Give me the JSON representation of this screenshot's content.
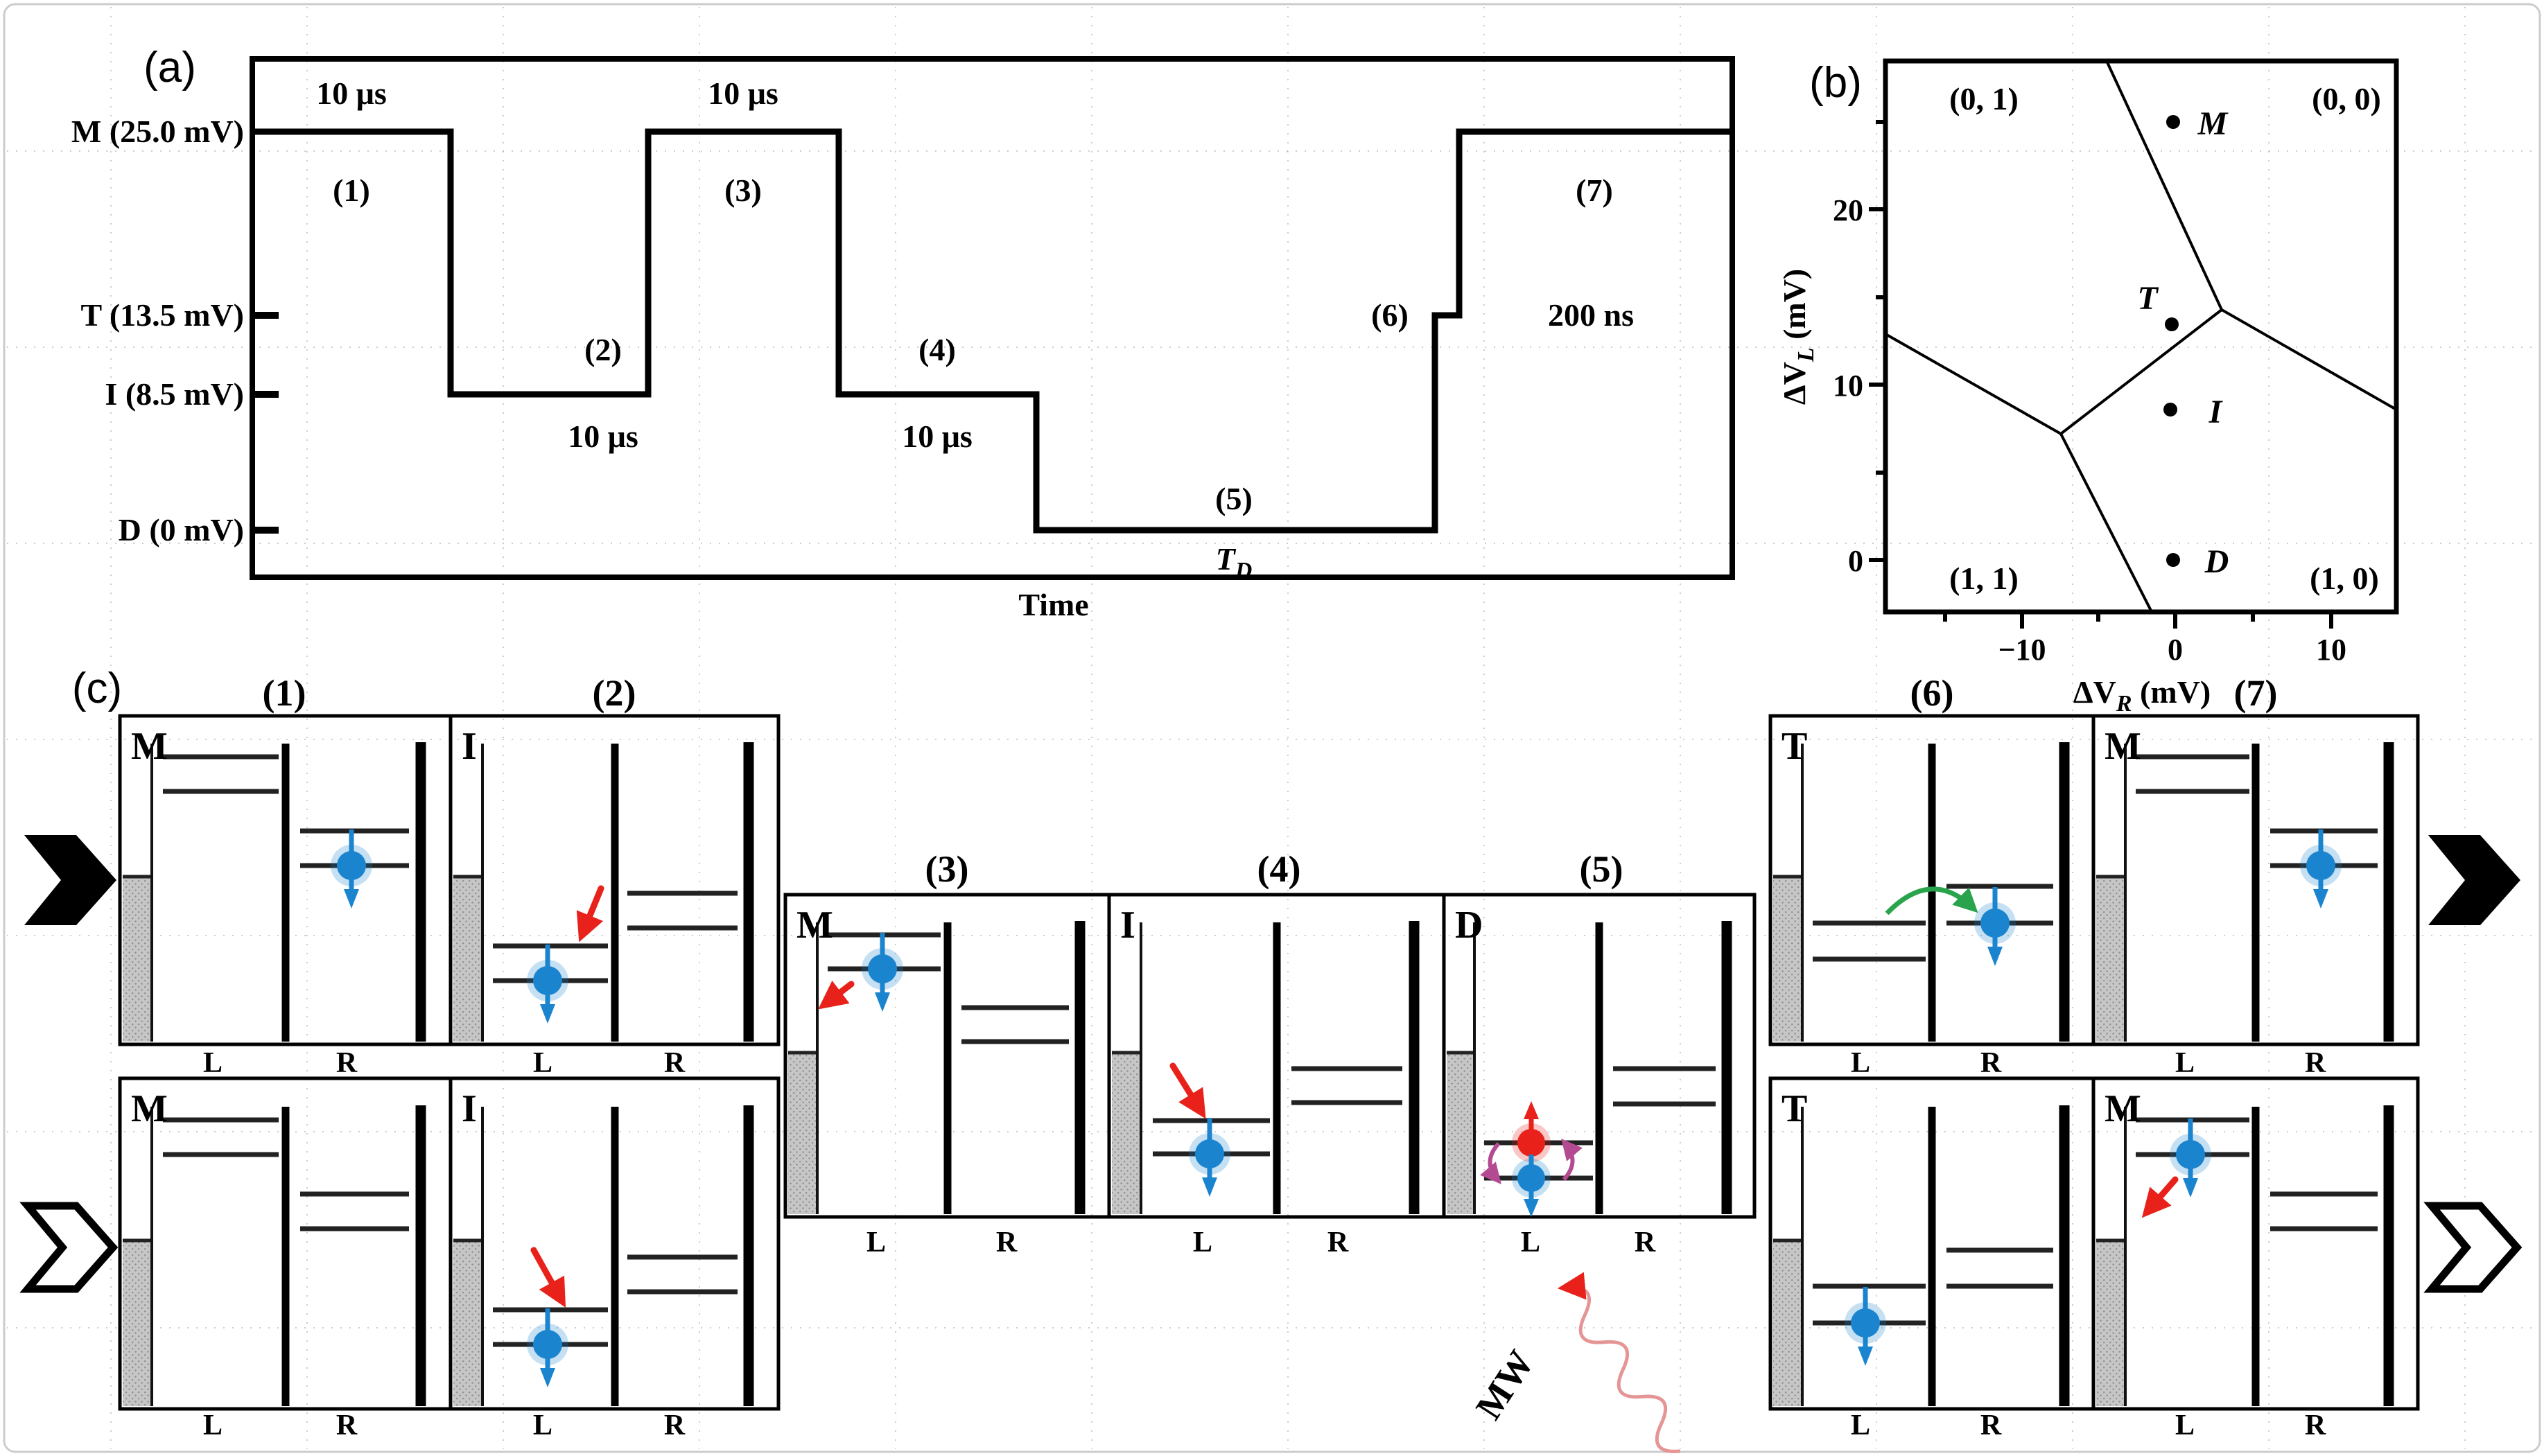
{
  "panel_a": {
    "tag": "(a)",
    "levels": [
      {
        "name": "M",
        "label": "M (25.0 mV)",
        "mV": 25
      },
      {
        "name": "T",
        "label": "T (13.5 mV)",
        "mV": 13.5
      },
      {
        "name": "I",
        "label": "I (8.5 mV)",
        "mV": 8.5
      },
      {
        "name": "D",
        "label": "D (0 mV)",
        "mV": 0
      }
    ],
    "x_axis_label": "Time",
    "stages": [
      {
        "id": "(1)",
        "level": "M",
        "duration": "10 μs"
      },
      {
        "id": "(2)",
        "level": "I",
        "duration": "10 μs"
      },
      {
        "id": "(3)",
        "level": "M",
        "duration": "10 μs"
      },
      {
        "id": "(4)",
        "level": "I",
        "duration": "10 μs"
      },
      {
        "id": "(5)",
        "level": "D",
        "duration_symbol_main": "T",
        "duration_symbol_sub": "D"
      },
      {
        "id": "(6)",
        "level": "T"
      },
      {
        "id": "(7)",
        "level": "M",
        "duration": "200 ns"
      }
    ]
  },
  "panel_b": {
    "tag": "(b)",
    "x_axis": {
      "sym": "ΔV",
      "sub": "R",
      "unit": " (mV)",
      "ticks": [
        "−10",
        "0",
        "10"
      ]
    },
    "y_axis": {
      "sym": "ΔV",
      "sub": "L",
      "unit": " (mV)",
      "ticks": [
        "0",
        "10",
        "20"
      ]
    },
    "charge_regions": [
      {
        "label": "(0, 1)",
        "position": "top-left"
      },
      {
        "label": "(0, 0)",
        "position": "top-right"
      },
      {
        "label": "(1, 1)",
        "position": "bottom-left"
      },
      {
        "label": "(1, 0)",
        "position": "bottom-right"
      }
    ],
    "operating_points": [
      {
        "name": "M",
        "dVR_mV": 0,
        "dVL_mV": 25
      },
      {
        "name": "T",
        "dVR_mV": 0,
        "dVL_mV": 13.5
      },
      {
        "name": "I",
        "dVR_mV": 0,
        "dVL_mV": 8.5
      },
      {
        "name": "D",
        "dVR_mV": 0,
        "dVL_mV": 0
      }
    ]
  },
  "panel_c": {
    "tag": "(c)",
    "dot_labels": {
      "left": "L",
      "right": "R"
    },
    "mw_label": "MW",
    "stage_headers": [
      "(1)",
      "(2)",
      "(3)",
      "(4)",
      "(5)",
      "(6)",
      "(7)"
    ],
    "panels": [
      {
        "row": "spin-down",
        "stage": "(1)",
        "point": "M",
        "electron": "spin-down in R dot"
      },
      {
        "row": "spin-down",
        "stage": "(2)",
        "point": "I",
        "electron": "spin-down in L dot, load arrow"
      },
      {
        "row": "shared",
        "stage": "(3)",
        "point": "M",
        "electron": "spin-down in L dot, unload arrow"
      },
      {
        "row": "shared",
        "stage": "(4)",
        "point": "I",
        "electron": "spin-down in L dot, load arrow"
      },
      {
        "row": "shared",
        "stage": "(5)",
        "point": "D",
        "electron": "spin-up and spin-down in L dot, MW drive"
      },
      {
        "row": "spin-down",
        "stage": "(6)",
        "point": "T",
        "electron": "spin-down in R dot, tunnel arrow"
      },
      {
        "row": "spin-down",
        "stage": "(7)",
        "point": "M",
        "electron": "spin-down in R dot"
      },
      {
        "row": "spin-up",
        "stage": "(1)",
        "point": "M",
        "electron": "none"
      },
      {
        "row": "spin-up",
        "stage": "(2)",
        "point": "I",
        "electron": "spin-down in L dot, load arrow"
      },
      {
        "row": "spin-up",
        "stage": "(6)",
        "point": "T",
        "electron": "spin-down in L dot"
      },
      {
        "row": "spin-up",
        "stage": "(7)",
        "point": "M",
        "electron": "spin-down in L dot, unload arrow"
      }
    ]
  },
  "colors": {
    "electron_blue": "#1b84cf",
    "electron_red": "#e8211a",
    "transition_red": "#e8211a",
    "tunnel_green": "#2aa44c",
    "rotation_purple": "#b44b92",
    "mw_wave_pink": "#e59595",
    "reservoir_gray": "#c6c6c6"
  },
  "chart_data": [
    {
      "type": "line",
      "title": "Gate voltage pulse sequence",
      "xlabel": "Time",
      "ylabel": "Pulse level",
      "levels_mV": {
        "M": 25.0,
        "T": 13.5,
        "I": 8.5,
        "D": 0
      },
      "sequence": [
        {
          "stage": "(1)",
          "level": "M",
          "mV": 25.0,
          "duration": "10 μs"
        },
        {
          "stage": "(2)",
          "level": "I",
          "mV": 8.5,
          "duration": "10 μs"
        },
        {
          "stage": "(3)",
          "level": "M",
          "mV": 25.0,
          "duration": "10 μs"
        },
        {
          "stage": "(4)",
          "level": "I",
          "mV": 8.5,
          "duration": "10 μs"
        },
        {
          "stage": "(5)",
          "level": "D",
          "mV": 0,
          "duration": "T_D"
        },
        {
          "stage": "(6)",
          "level": "T",
          "mV": 13.5,
          "duration": ""
        },
        {
          "stage": "(7)",
          "level": "M",
          "mV": 25.0,
          "duration": "200 ns"
        }
      ]
    },
    {
      "type": "scatter",
      "title": "Charge stability diagram",
      "xlabel": "ΔV_R (mV)",
      "ylabel": "ΔV_L (mV)",
      "xlim": [
        -18.8,
        14.4
      ],
      "ylim": [
        -3.0,
        28.5
      ],
      "x_ticks": [
        -10,
        0,
        10
      ],
      "y_ticks": [
        0,
        10,
        20
      ],
      "points": [
        {
          "label": "M",
          "x": 0,
          "y": 25
        },
        {
          "label": "T",
          "x": 0,
          "y": 13.5
        },
        {
          "label": "I",
          "x": 0,
          "y": 8.5
        },
        {
          "label": "D",
          "x": 0,
          "y": 0
        }
      ],
      "regions": [
        "(0, 1)",
        "(0, 0)",
        "(1, 1)",
        "(1, 0)"
      ],
      "boundary_lines": [
        [
          [
            -4.4,
            28.5
          ],
          [
            3.0,
            14.2
          ]
        ],
        [
          [
            3.0,
            14.2
          ],
          [
            14.4,
            8.5
          ]
        ],
        [
          [
            3.0,
            14.2
          ],
          [
            -7.4,
            7.2
          ]
        ],
        [
          [
            -7.4,
            7.2
          ],
          [
            -18.8,
            13.0
          ]
        ],
        [
          [
            -7.4,
            7.2
          ],
          [
            -1.6,
            -3.0
          ]
        ]
      ]
    }
  ]
}
